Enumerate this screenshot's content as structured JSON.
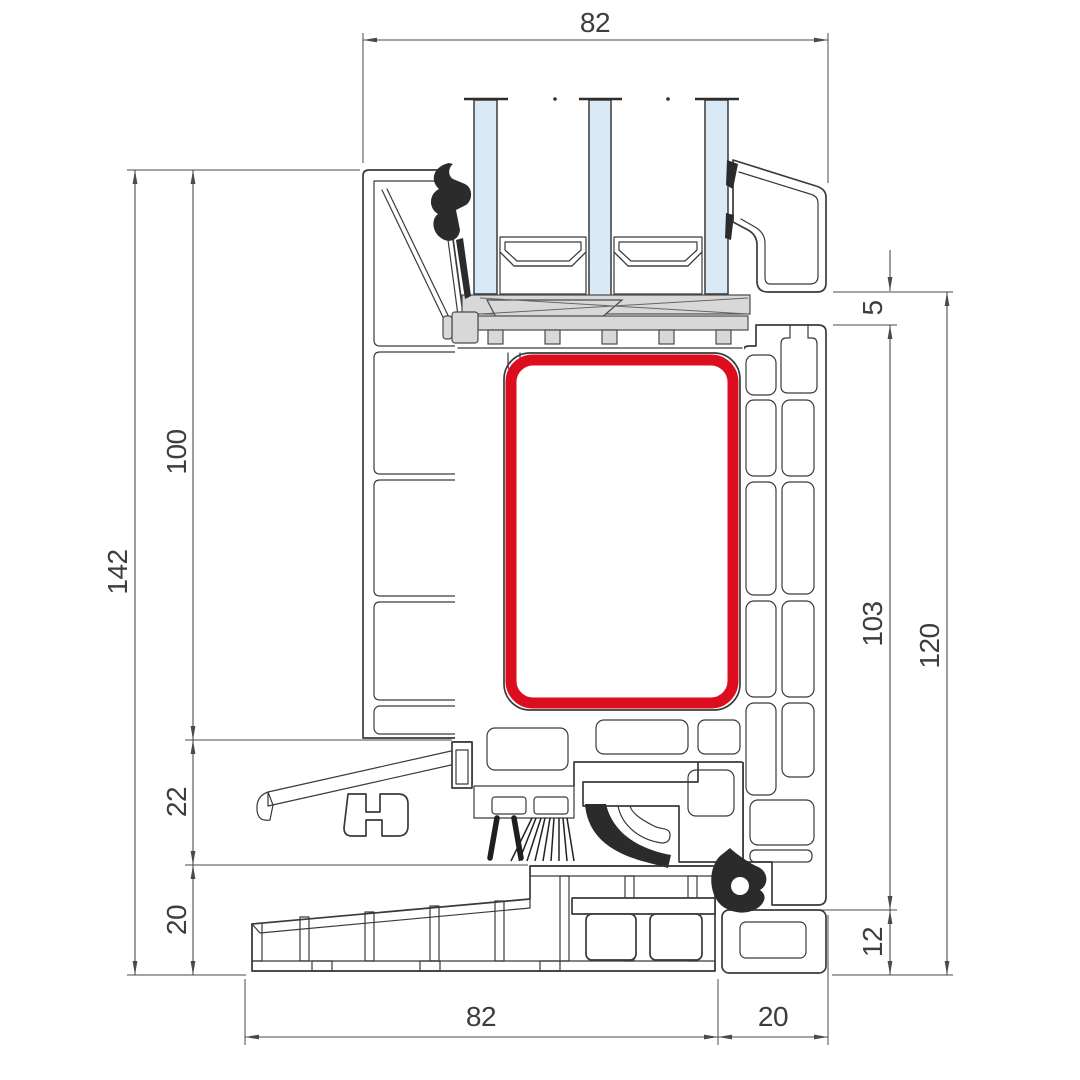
{
  "dimensions": {
    "top_width": "82",
    "left_total_height": "142",
    "left_upper_height": "100",
    "left_middle_height": "22",
    "left_lower_height": "20",
    "right_gap": "5",
    "right_frame_height": "103",
    "right_total_height": "120",
    "right_bottom_inset": "12",
    "bottom_sill_width": "82",
    "bottom_right_width": "20"
  },
  "colors": {
    "line": "#3a3a3a",
    "reinforcement_red": "#dc0d1e",
    "glass_blue": "#d9e9f5",
    "support_gray": "#d8d8d8",
    "seal_black": "#2b2b2b"
  }
}
